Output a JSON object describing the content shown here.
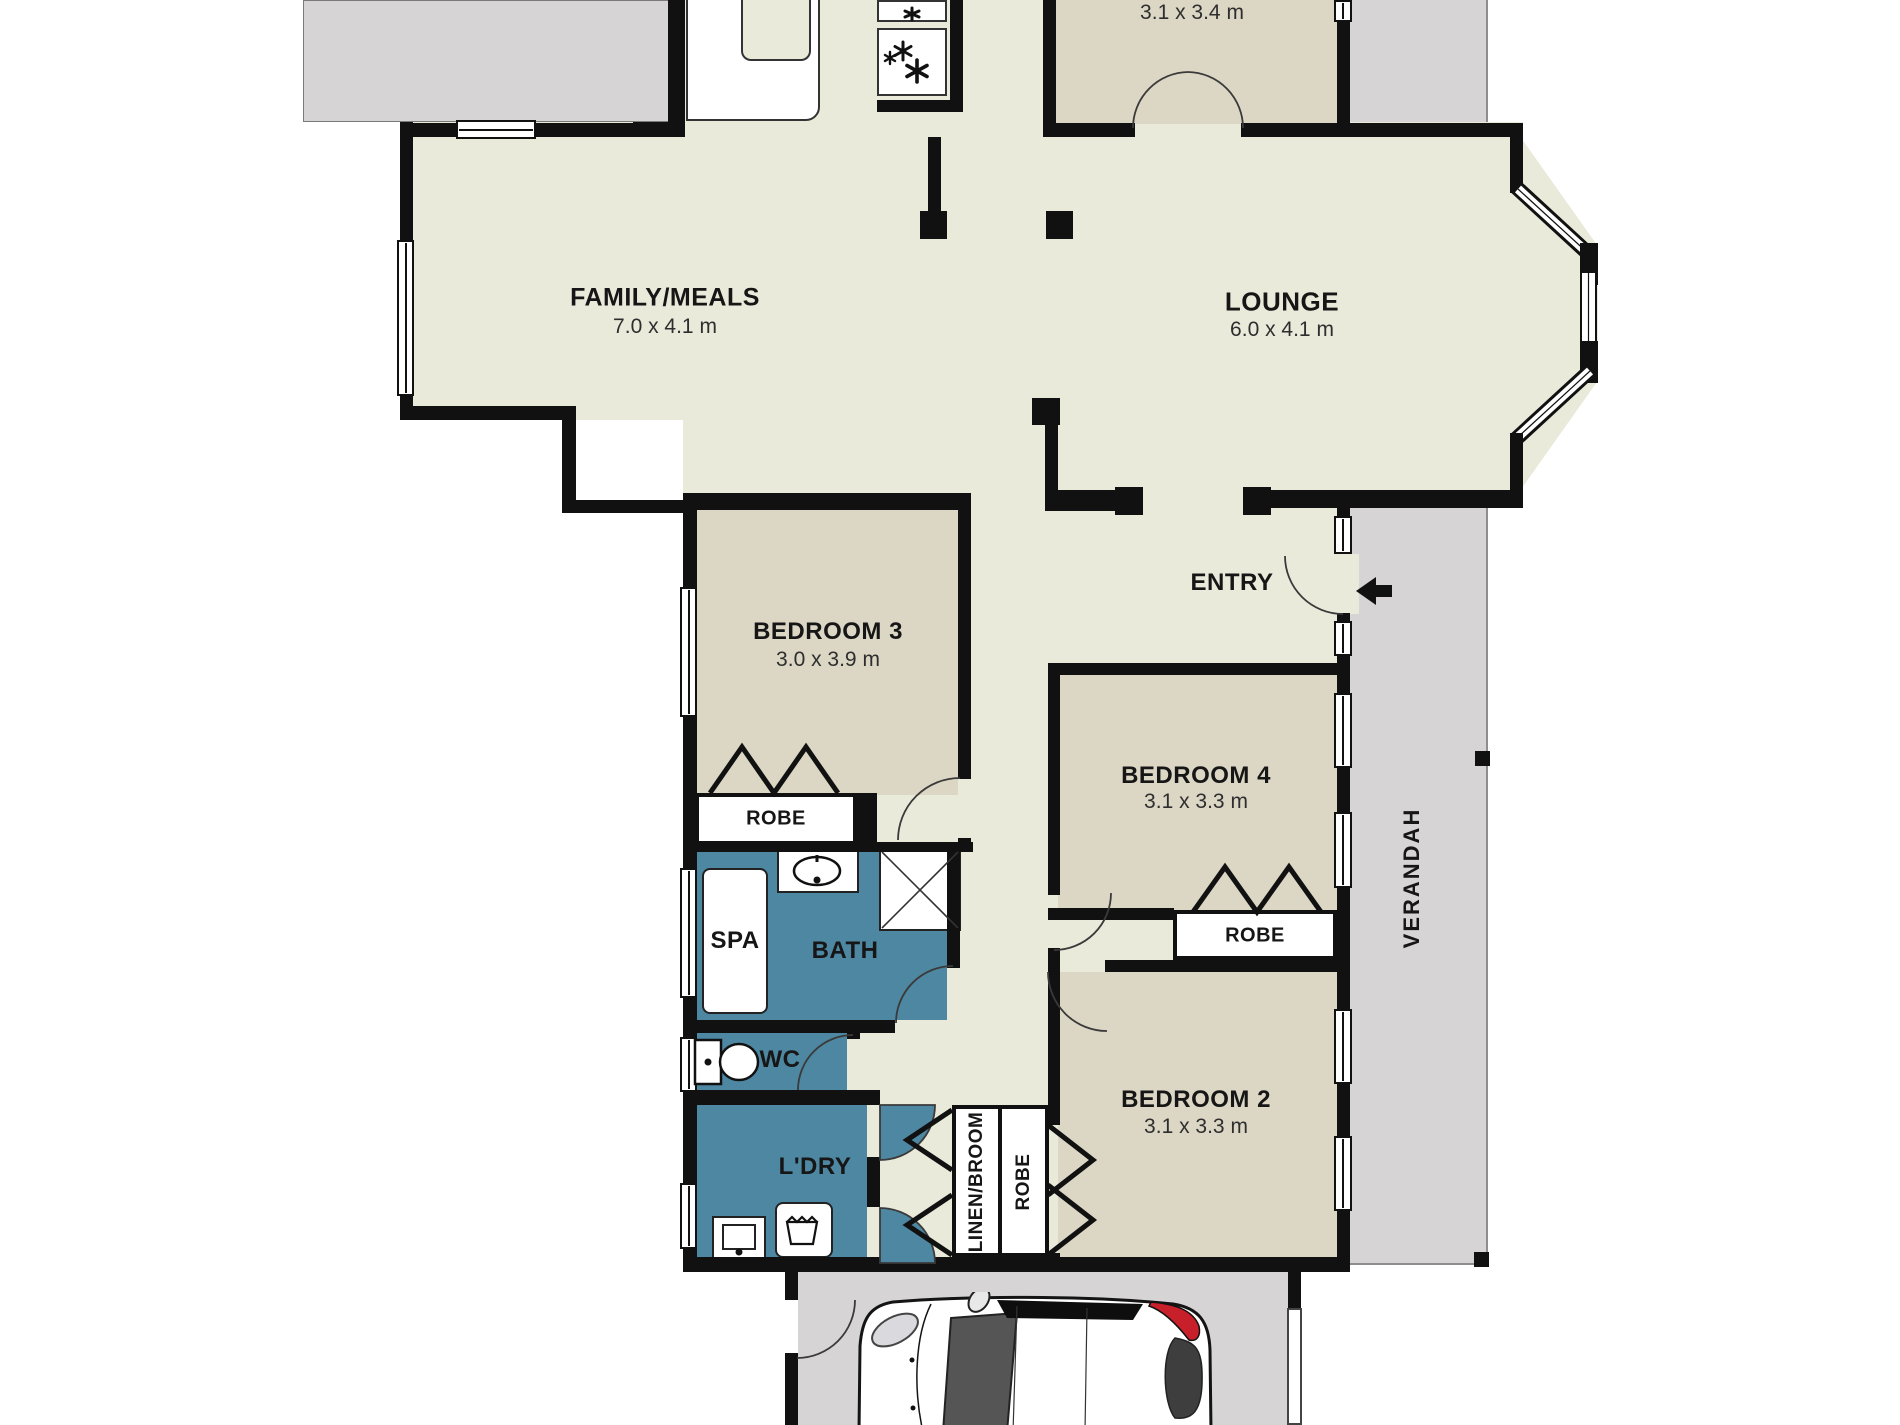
{
  "rooms": {
    "top_room": {
      "dims": "3.1 x 3.4 m"
    },
    "family": {
      "name": "FAMILY/MEALS",
      "dims": "7.0 x 4.1 m"
    },
    "lounge": {
      "name": "LOUNGE",
      "dims": "6.0 x 4.1 m"
    },
    "entry": {
      "name": "ENTRY"
    },
    "bedroom3": {
      "name": "BEDROOM 3",
      "dims": "3.0 x 3.9 m"
    },
    "bedroom4": {
      "name": "BEDROOM 4",
      "dims": "3.1 x 3.3 m"
    },
    "bedroom2": {
      "name": "BEDROOM 2",
      "dims": "3.1 x 3.3 m"
    },
    "spa": {
      "name": "SPA"
    },
    "bath": {
      "name": "BATH"
    },
    "wc": {
      "name": "WC"
    },
    "laundry": {
      "name": "L'DRY"
    },
    "linen": {
      "name": "LINEN/BROOM"
    },
    "robe_bed3": {
      "name": "ROBE"
    },
    "robe_bed4": {
      "name": "ROBE"
    },
    "robe_bed2": {
      "name": "ROBE"
    },
    "verandah": {
      "name": "VERANDAH"
    }
  },
  "colors": {
    "floor": "#eaeadb",
    "room_fill": "#dcd6c4",
    "wet_area": "#4e87a2",
    "outdoor": "#d6d4d5",
    "wall": "#111111",
    "taillight_red": "#c8202a"
  }
}
